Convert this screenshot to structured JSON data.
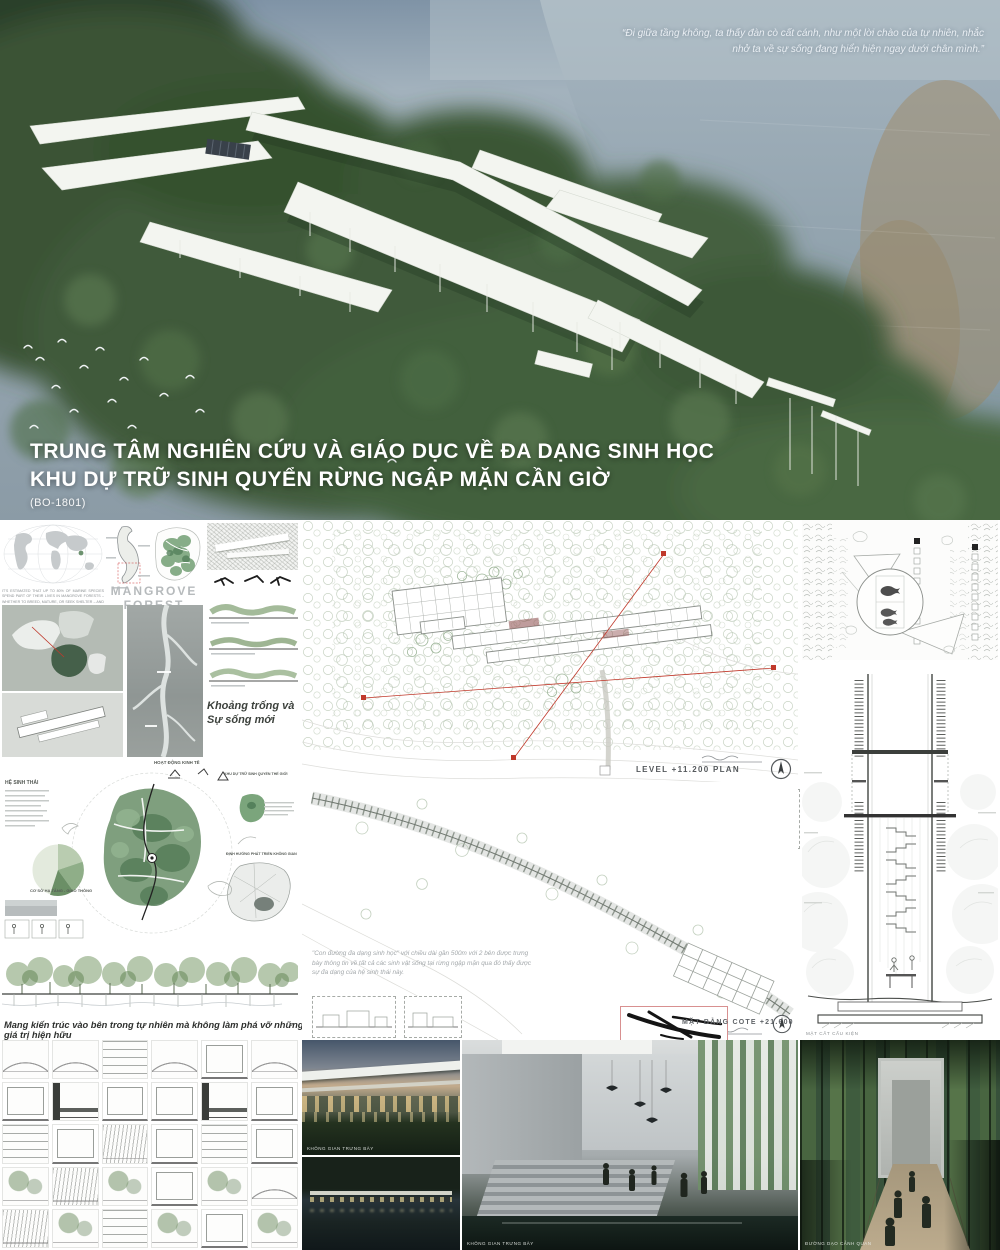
{
  "hero": {
    "quote_line1": "“Đi giữa tầng không, ta thấy đàn cò cất cánh, như một lời chào của tự nhiên, nhắc",
    "quote_line2": "nhở ta về sự sống đang hiển hiện ngay dưới chân mình.”",
    "title_line1": "TRUNG TÂM NGHIÊN CỨU VÀ GIÁO DỤC VỀ ĐA DẠNG SINH HỌC",
    "title_line2": "KHU DỰ TRỮ SINH QUYỂN RỪNG NGẬP MẶN CẦN GIỜ",
    "code": "(BO-1801)"
  },
  "left": {
    "mangrove_title": "MANGROVE FOREST",
    "world_caption": "IT'S ESTIMATED THAT UP TO 80% OF MARINE SPECIES SPEND PART OF THEIR LIVES IN MANGROVE FORESTS – WHETHER TO BREED, MATURE, OR SEEK SHELTER – AND 80% OF GLOBAL SEAFOOD EXTRACTION RELIES ON THIS ECOSYSTEM.",
    "khoang_line1": "Khoảng trống và",
    "khoang_line2": "Sự sống mới",
    "he_sinh_thai": "HỆ SINH THÁI",
    "hoat_dong_kinh_te": "HOẠT ĐỘNG KINH TẾ",
    "khu_du_tru": "KHU DỰ TRỮ SINH QUYỂN THẾ GIỚI",
    "dinh_huong": "ĐỊNH HƯỚNG PHÁT TRIỂN KHÔNG GIAN",
    "ha_tang": "CƠ SỞ HẠ TẦNG - GIAO THÔNG",
    "caption_bottom": "Mang kiến trúc vào bên trong tự nhiên mà không làm phá vỡ những giá trị hiện hữu"
  },
  "center": {
    "level_label": "LEVEL +11.200 PLAN",
    "legend": [
      "01. LOBBY",
      "02. EXHIBITION HALL / GALLERY",
      "03. INTERACTIVE COMMON AREA",
      "04. FLEXIBLE LECTURE THEATER",
      "05. ADMINISTRATION & MANAGEMENT",
      "06. LIBRARY",
      "07. MOTION PICTURE ROOM",
      "08. OFFICE",
      "09. RESEARCH LAB",
      "10. AIR FILTRATION",
      "11. LABORATORY / GROWING ROOM",
      "12. BATHROOM",
      "13. TECHNICAL",
      "14. OUTDOOR LANDSCAPE"
    ],
    "box_labels": [
      "QUAN SÁT",
      "TRƯNG BÀY",
      "HIỂU BIẾT"
    ],
    "paragraph": "\"Con đường đa dạng sinh học\" với chiều dài gần 500m với 2 bên được trưng bày thông tin về tất cả các sinh vật sống tại rừng ngập mặn qua đó thấy được sự đa dạng của hệ sinh thái này.",
    "matbang_label": "MẶT BẰNG COTE +21.600",
    "render_exhibition_label": "KHÔNG GIAN TRƯNG BÀY",
    "render_interior_label": "KHÔNG GIAN TRƯNG BÀY"
  },
  "right": {
    "section_label": "MẶT CẮT CẤU KIỆN",
    "walk_label": "ĐƯỜNG DẠO CẢNH QUAN"
  }
}
